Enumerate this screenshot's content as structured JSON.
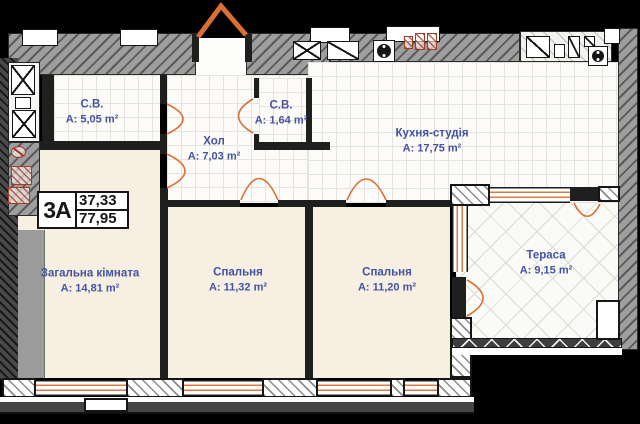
{
  "unit": {
    "code": "3А",
    "living_area": "37,33",
    "total_area": "77,95"
  },
  "rooms": [
    {
      "id": "bathroom-1",
      "name": "С.В.",
      "area": "A: 5,05 m²"
    },
    {
      "id": "hall",
      "name": "Хол",
      "area": "A: 7,03 m²"
    },
    {
      "id": "bathroom-2",
      "name": "С.В.",
      "area": "A: 1,64 m²"
    },
    {
      "id": "kitchen-studio",
      "name": "Кухня-студія",
      "area": "A: 17,75 m²"
    },
    {
      "id": "living-room",
      "name": "Загальна кімната",
      "area": "A: 14,81 m²"
    },
    {
      "id": "bedroom-1",
      "name": "Спальня",
      "area": "A: 11,32 m²"
    },
    {
      "id": "bedroom-2",
      "name": "Спальня",
      "area": "A: 11,20 m²"
    },
    {
      "id": "terrace",
      "name": "Тераса",
      "area": "A: 9,15 m²"
    }
  ],
  "colors": {
    "door_accent": "#d96f35",
    "label_text": "#4352a3",
    "wall_dark": "#1f1f1f",
    "wall_gray": "#9e9e9e",
    "floor_beige": "#f6efe2",
    "background": "#000000"
  }
}
